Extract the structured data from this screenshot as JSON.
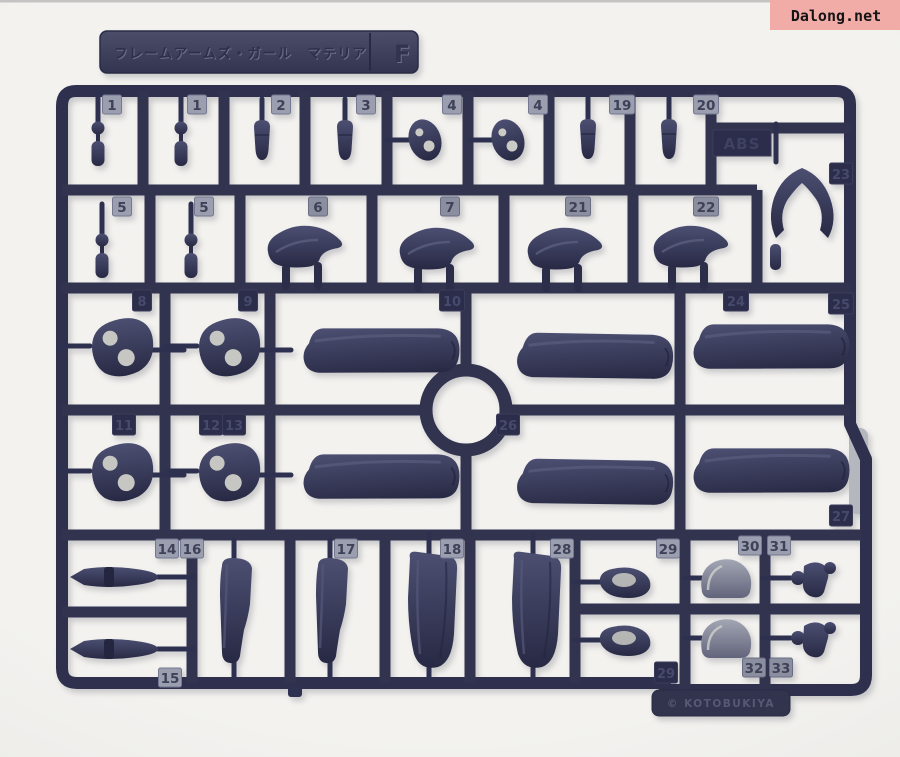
{
  "watermark": {
    "text": "Dalong.net",
    "bg_color": "#F1ACA7"
  },
  "runner_tag": {
    "title": "フレームアームズ・ガール　マテリア",
    "letter": "F"
  },
  "markings": {
    "material": "ABS",
    "copyright": "© KOTOBUKIYA"
  },
  "colors": {
    "plastic_navy": "#2F3150",
    "background": "#F0EFEC",
    "tab_light": "#9A9EAE",
    "part_hole": "#C6C6C2"
  },
  "tabs": {
    "row1": [
      "1",
      "1",
      "2",
      "3",
      "4",
      "4",
      "19",
      "20"
    ],
    "row2": [
      "5",
      "5",
      "6",
      "7",
      "21",
      "22"
    ],
    "right_column": [
      "23"
    ],
    "row3": [
      "8",
      "9",
      "10",
      "24",
      "25"
    ],
    "row4": [
      "11",
      "12",
      "13",
      "26",
      "27"
    ],
    "row5_top": [
      "14",
      "16",
      "17",
      "18",
      "28",
      "29",
      "30",
      "31"
    ],
    "row5_bottom": [
      "15",
      "29",
      "32",
      "33"
    ]
  }
}
